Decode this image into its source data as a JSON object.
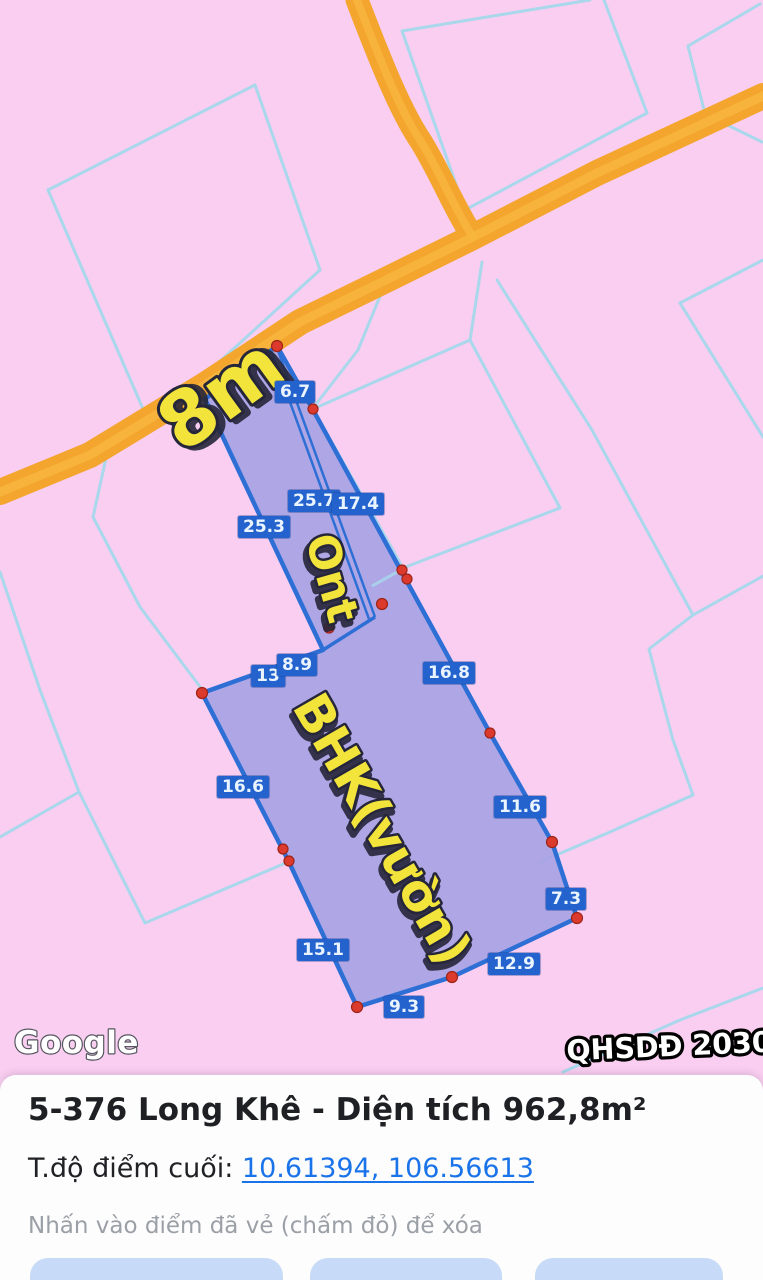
{
  "map": {
    "annotations": {
      "road_width": "8m",
      "road_type": "Ont",
      "land_use": "BHK(vườn)"
    },
    "measurements": [
      "6.7",
      "25.7",
      "17.4",
      "25.3",
      "13",
      "8.9",
      "16.8",
      "16.6",
      "11.6",
      "7.3",
      "15.1",
      "12.9",
      "9.3"
    ],
    "attribution": "Google",
    "plan_badge": "QHSDĐ 2030",
    "colors": {
      "map_background": "#F9CEF1",
      "boundary_line": "#A9D7EB",
      "road_fill": "#F3A52E",
      "parcel_fill": "#A8A3E4",
      "parcel_stroke": "#2E6FD6",
      "measurement_bg": "#2463CE",
      "drawn_point": "#DC3A2C",
      "annotation_yellow": "#F3E43B"
    }
  },
  "panel": {
    "title_name": "5-376 Long Khê",
    "title_separator": " - ",
    "area_label": "Diện tích ",
    "area_value": "962,8m²",
    "coord_label": "T.độ điểm cuối: ",
    "coord_value": "10.61394, 106.56613",
    "hint": "Nhấn vào điểm đã vẻ (chấm đỏ) để xóa",
    "link_color": "#1A73E8"
  }
}
